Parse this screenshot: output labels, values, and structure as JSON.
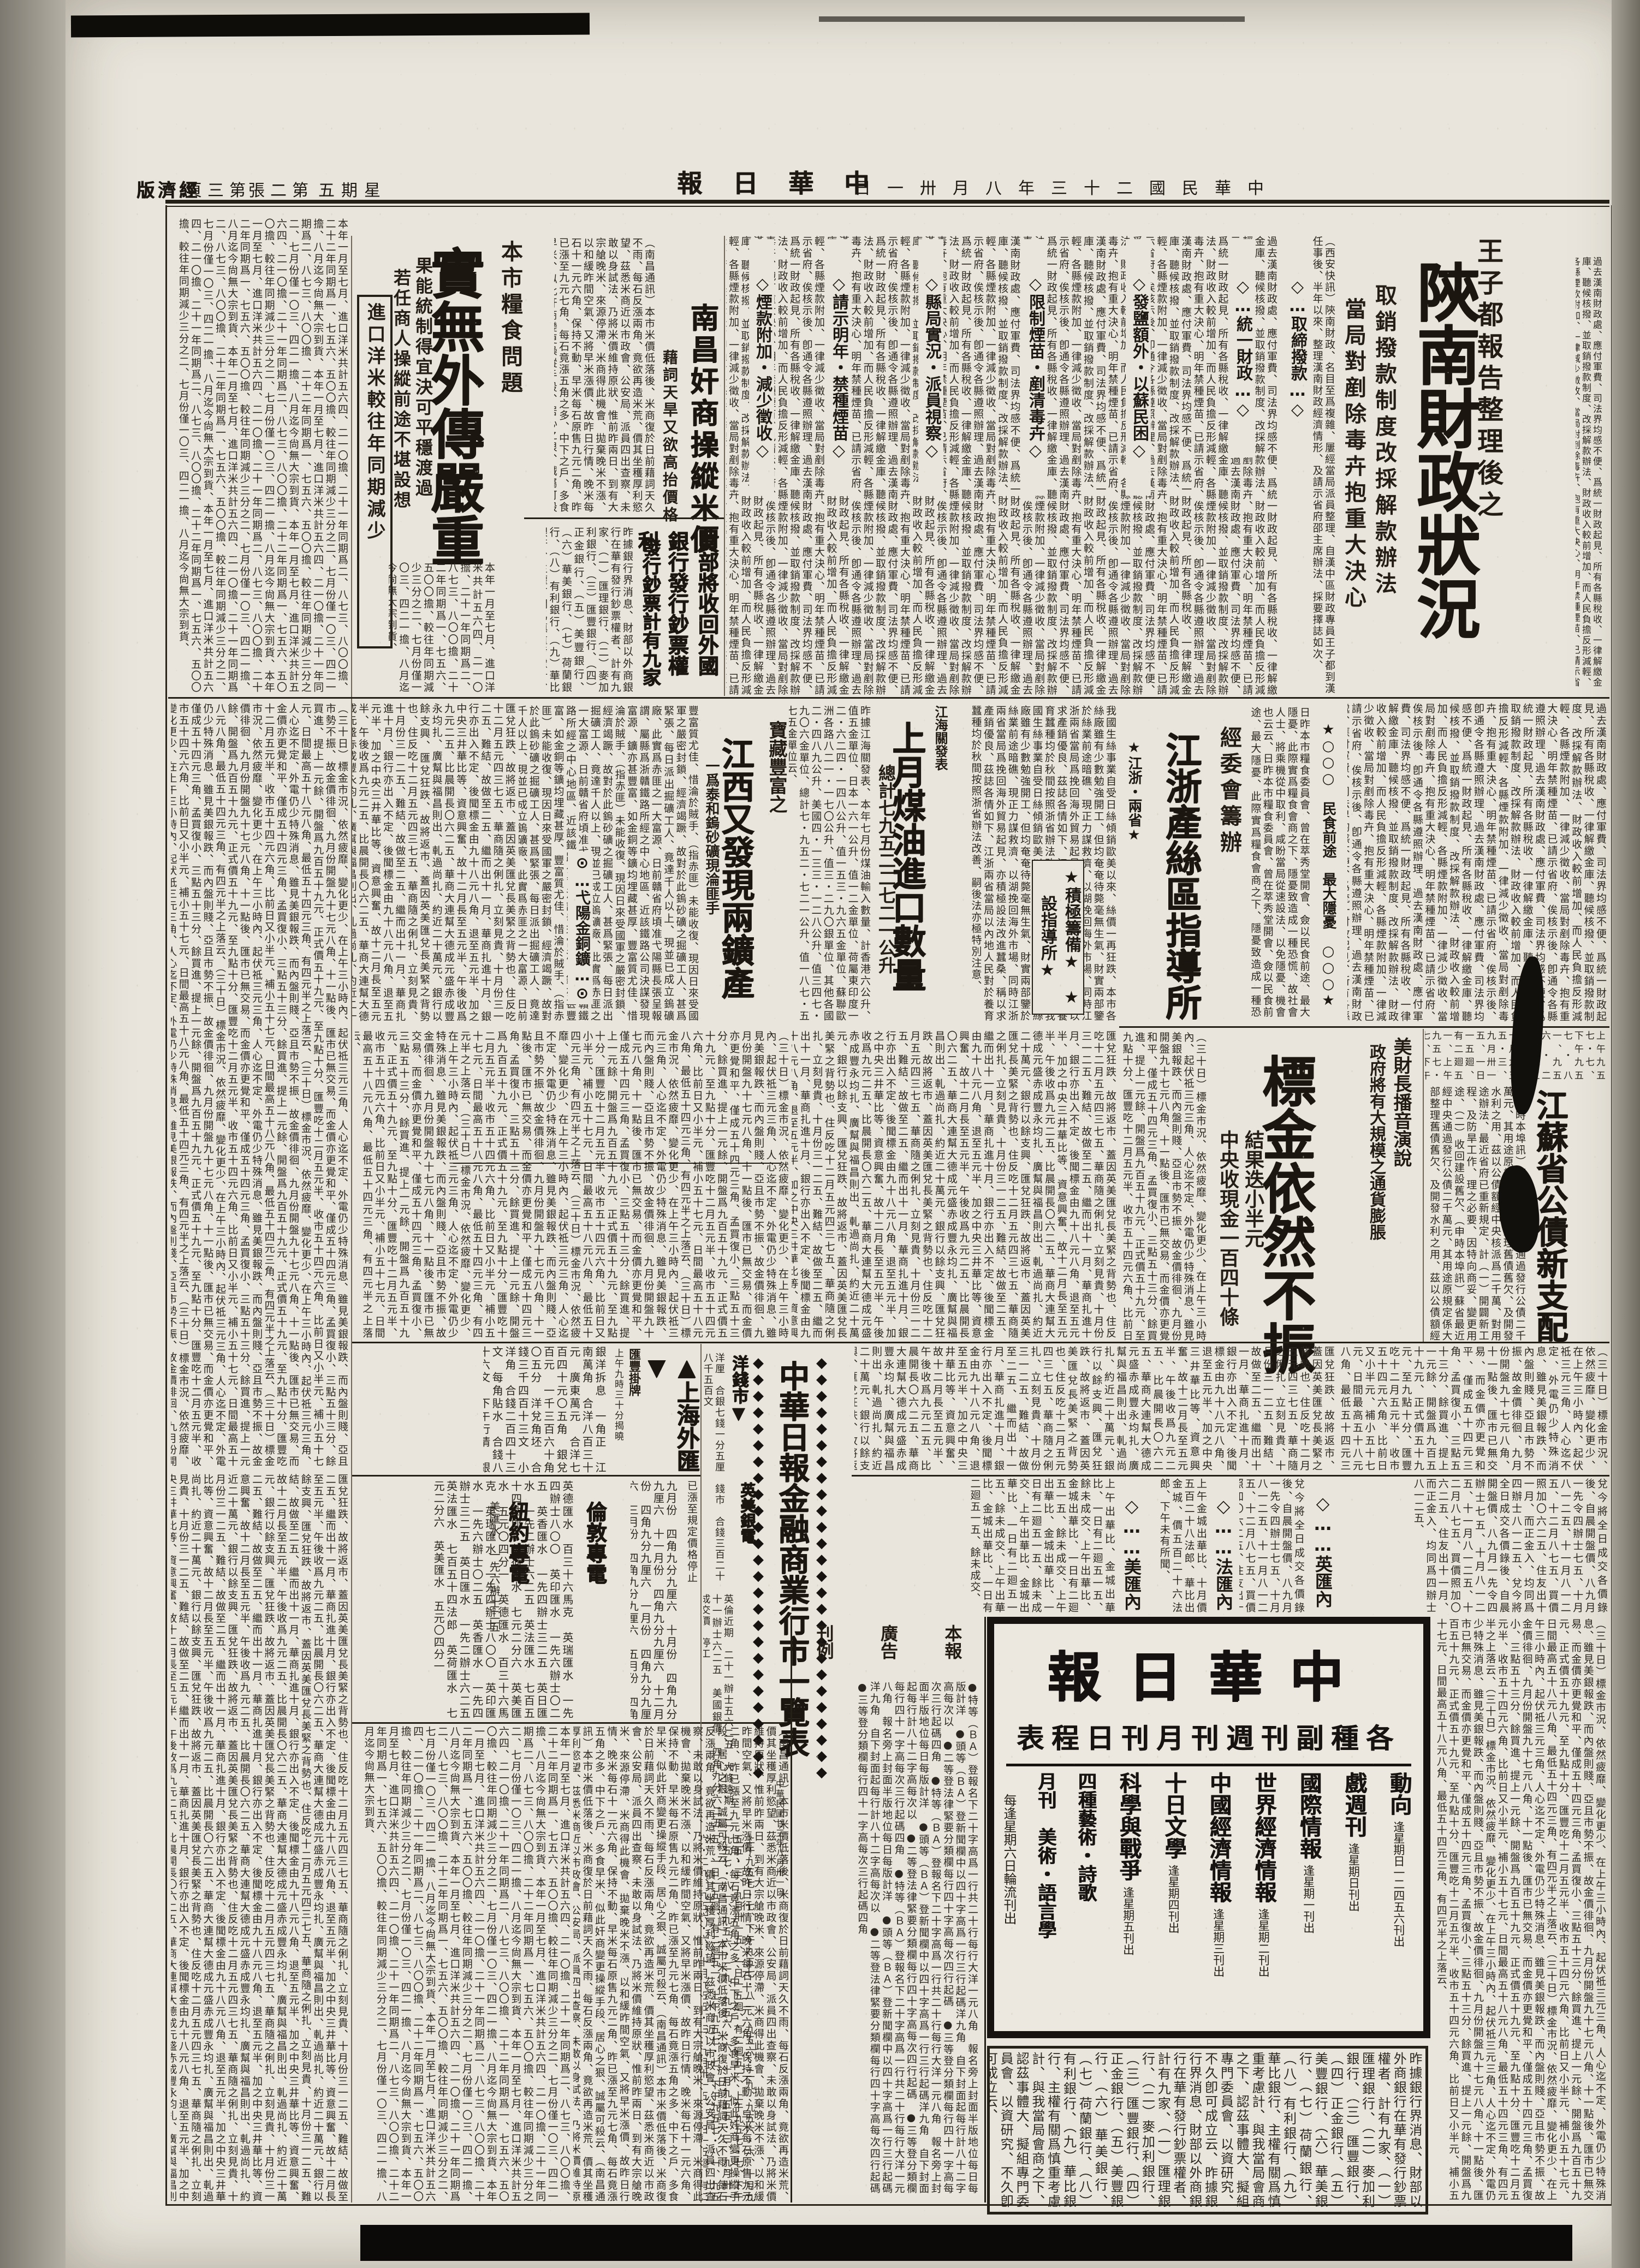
{
  "page": {
    "paper_color": "#e9e5dc",
    "ink_color": "#241f17"
  },
  "header": {
    "masthead": "中華日報",
    "date": "中華民國二十三年八月卅一日",
    "weekday": "星期五",
    "sheet": "第二張",
    "page_no": "第三頁",
    "section": "經濟版"
  },
  "stories": {
    "shaanxi": {
      "kicker": "王子都報告整理後之",
      "headline": "陝南財政狀況",
      "deck1": "取銷撥款制度改採解款辦法",
      "deck2": "當局對剷除毒卉抱重大決心",
      "lead": "（西安快訊）陝南財政、名目至爲複雜、屢經當局派員整理、自漢中區財政專員王子都到漢任事後、半年以來、整理漢南財政經濟情形、及請示省府邵主席辦法、採要擇誌如次、",
      "subheads": [
        "◇…取締撥款…◇",
        "◇…統一財政…◇",
        "◇發鹽額外・以蘇民困◇",
        "◇限制煙苗・剷清毒卉◇",
        "◇縣局實況・派員視察◇",
        "◇請示明年・禁種煙苗◇",
        "◇煙款附加・減少徵收◇"
      ]
    },
    "food": {
      "kicker": "本市糧食問題",
      "headline": "實無外傳嚴重",
      "deck1": "果能統制得宜決可平穩渡過",
      "deck2": "若任商人操縱前途不堪設想",
      "box_label": "進口洋米較往年同期減少"
    },
    "nanchang": {
      "headline": "南昌奸商操縱米價",
      "deck": "藉詞天旱又欲高抬價格"
    },
    "banknotes": {
      "headline": "財部將收回外國銀行發行鈔票權利",
      "deck": "發行鈔票計有九家"
    },
    "minfood": {
      "head": "★○○○　民食前途　最大隱憂　○○○★"
    },
    "silk": {
      "kicker": "經委會籌辦",
      "headline": "江浙產絲區指導所",
      "star1": "★江浙・兩省★",
      "starbox": "★積極籌備★　★設指導所★"
    },
    "kerosene": {
      "kicker": "江海關發表",
      "headline": "上月煤油進口數量",
      "deck": "總計七九五二二七二一公升"
    },
    "mines": {
      "kicker": "寶藏豐富之",
      "headline": "江西又發現兩鑛產",
      "deck": "一爲泰和鎢砂礦現淪匪手",
      "subhead": "⊙…弋陽金銅鑛…⊙"
    },
    "bonds": {
      "headline": "江蘇省公債新支配"
    },
    "gold": {
      "kicker1": "美財長播音演說",
      "kicker2": "政府將有大規模之通貨膨脹",
      "headline": "標金依然不振",
      "deck1": "結果迭小半元",
      "deck2": "中央收現金一百四十條"
    }
  },
  "tables": {
    "banner": "中華日報金融商業行市一覽表",
    "banner_note": "中華民國廿三年八月卅一日",
    "banner_deco": "◆",
    "shfx_header": "▲上海外匯▼",
    "shfx_sub": "匯豐掛牌",
    "shfx_time": "上午九時三十分揭曉",
    "shfx_rows": "銀洋拆息　一角正　江南萬角　合洋八百三十元　廣東萬元　合洋七百四十元〇五角　銀兌百元　一千三百六十角〇五分　洋兌角坯　合錢三千四百十三文　小洋角　合錢二百四十三文　每角貼水　合錢八十六文　下午行情　銀洋拆息　一角正　江南萬角　合洋八百三十元　廣東萬元　合洋七百四十元〇五角　銀兌百元　一千三百六十角〇五分　每角貼水　合錢八十六文",
    "ny_header": "紐約專電",
    "ny_rows": "美匯水　一先六辦士二五",
    "ldn_header": "倫敦專電",
    "ldn_rows": "英德匯水　百三十六馬克　英瑞匯水　一先四辦士八〇〇　英印匯水　一先六辦士〇二五　英香匯水　一先四辦士三二五　英日匯水　一先二辦士六二五　英法匯水　七百五十四法郎　英荷匯水　七元二分六　英美匯水　五元〇四分一　",
    "silver_note": "已漲至規定價格停止",
    "silver_rows": "九月份　四角九分九厘六　十月份　四角九分九厘六　十一月份　四角九分九厘六　十二月份　四角九分九厘六　一月份　四角九分九厘六　三月份　四角九分九厘六　五月份　四角九分九厘六　",
    "ym_header": "英美銀電",
    "ym_rows": "英倫近期　二十一辦士五六二五　大條遠期　二十一辦士六二五　美國銀價　四角九分六二五　成交價　停工",
    "yq_header": "洋錢市▼",
    "yq_rows": "洋厘　合銀七錢一分五厘　錢市　合錢三百二十八千五百文",
    "np_ying": "◇……英匯內盤……◇",
    "np_fa": "◇……法匯內盤……◇",
    "np_mei": "◇……美匯內盤……◇"
  },
  "adbox": {
    "brand": "中華日報",
    "title": "各種副刊週刊月刊日程表",
    "items": [
      {
        "name": "動向",
        "sched": "逢星期日一二四五六刊出"
      },
      {
        "name": "戲週刊",
        "sched": "逢星期日刊出"
      },
      {
        "name": "國際情報",
        "sched": "逢星期一刊出"
      },
      {
        "name": "世界經濟情報",
        "sched": "逢星期二刊出"
      },
      {
        "name": "中國經濟情報",
        "sched": "逢星期三刊出"
      },
      {
        "name": "十日文學",
        "sched": "逢星期四刊出"
      },
      {
        "name": "科學與戰爭",
        "sched": "逢星期五刊出"
      },
      {
        "name": "四種藝術・詩歌",
        "sched": ""
      },
      {
        "name": "月刊　美術・語言學",
        "sched": ""
      }
    ],
    "note": "每逢星期六日輪流刊出"
  },
  "rates": {
    "labels": [
      "本報",
      "廣告",
      "刊例"
    ],
    "body": "●特等（ＢＡ）登報名下二十字高爲一行共二十行每行大洋一元八角　報名旁上封面半版地位每日每版計洋　●頭等（ＢＡ）登新聞欄中以四十字高爲一行三行起碼洋九角　自下封面起每行計八十二字高每次以　●二等登法律緊要分類欄每行四十字高每次四行起碼　●三等登分類欄每行四十一字高每次三行起碼四角　"
  },
  "filler": {
    "f1": "過去漢南財政處、應付軍費、司法界均感不便、爲統一財政起見、所有各縣稅收、一律解繳金庫、聽候核撥、並取銷撥款制度、改採解款辦法、財政收入較前增加、而人民負擔反形減輕、各縣煙款附加、一律減少徵收、當局對剷除毒卉、抱有重大決心、明年禁種煙苗、已請示省府、俟核示後、卽通令各縣遵照辦理、",
    "f2": "（南昌通訊）本市米價低落後、米商復於日前藉詞天久不雨、每石反漲兩角、竟欲再造米荒、價其坐穫厚利慾望、茲悉米商近以市政會、公安局、派員四出查察、未敢以身試法、乃將米價維持原狀、惟前昨兩日、到有大宗艙晚米、來源停滯、米商得此機會、拋棄晚米不漲、以和緩昨間空氣、又將早米漲價、故昨日行情、晚米每石十一元六角、保持不動、早米每石原售九元二角、昨已漲至九元七角、每石竟漲五角之多、中下之戶、多食早米、似此奸商變更操縱手段、居心之狠、誠屬可殺云、",
    "f3": "昨據銀行界消息、財部以外商銀行在華有發行鈔票權者、計有九家、（一）匯理銀行、（二）麥加利銀行、（三）匯豐銀行、（四）正金銀行、（五）美豐銀行、（六）華美銀行、（七）荷蘭銀行、（八）有利銀行、（九）華比銀行、主權有關爲慎重考慮計、與我當局會商之下、認茲事體大、擬組專門委員會、以資研究、不久卽可成立云、",
    "f4": "我國生絲事業自受日絲傾銷歐美以來、絲價一再狂跌、本市各絲廠雖有少數勉強開工、但均奄奄待斃毫無生氣、財實兩部鑒於絲業前途暗礁、現正力謀救濟、以湖挽回海外市場、同時江浙兩省當局爲挽回海外貿易起見、亦積極設法改進蠶桑、稱以求產銷優良、茲誌各情如下、江浙兩省當局以內地人民對於養育蠶種均於秋間按照浙省辦法改善、嗣後法亦極特別注意、",
    "f5": "昨據江海關發表、本年七月份煤油輸入數量、計香港六公升、值五金單位、日本一六一公升、值一二金單位、荷屬東印度一二・六二四・一四八公升、值一五三・九六五金單位、蘇聯歐洲各路八二一・一七〇公升、值三・二九〇銀單位、其他各國二・四八九公升、美國四・一三三・一二八公升、值三四七・九〇六金單位、總計七・九五二・七二一公升、值一八七・五七五金單位云、",
    "f6": "（三十日）標金市況、依然疲靡、變化更少、在上午三小時內、起伏祗三元三角、人心迄不定、外電仍少特殊消息、雖見美銀報跌、而內盤則賤、亞且市勢不振、故金價徘徊、九月份開盤九十七元八角、十一點後、匯市已無交易、而金價亦更覺和平、僅成五十四元三角、孟買復小、三點五十三分、餘買進、提上一元餘、開盤爲九百五十九元、正式價五十九元、至九點十分、匯豐吃十二月五元半、收市五十四元六角、比前日又小半元、補小五十七元、日間最高五十八元八角、最低五十四元三角、有四元半之上落云、",
    "f7": "匯兌狂跌、故將返市、蓋因英美匯兌長美緊之背勢也、住反吃十二月五元四三七五、華商隨之俐扎、立刻見貴、十月份三一二五、難結、故做至二五、繼而出十一月、華商扎進十月、銀行亦出入不定、後聞標金由九十八元八角、退至五元半、加之中央三井華比等、資意興奮、故十二月長至五元半、午後收爲九元二五、比晨開長〇六二五、華商大連幫大德成元盛赤成豐永均扎、廣幫與福昌則出、軋過尚扎、約近二十萬元、銀行以餘支興、",
    "f8": "（申時本埠訊）蘇省最近經中央通過發行公債二千萬元、其用途原規定係大部整理舊債舊欠、及開發水利之用、茲以公債額經中央核派爲二千萬、對用途辦法、最近省府已重新規定、計（一）開闢新工程、及防旱工作、理之必要、因特向商妥、變更用途、（二）收回建設舊欠、",
    "f9": "豐富質尤佳、惜淪於賊手、（指赤匪）未能收復、現因日來受國軍之嚴密封鎖、經濟竭蹶、故對於此鎢砂礦之掘礦工人、甚爲緊張、每日派出掘礦工人、竟達千人以上、現並已成立鎢礦廠、此實爲赤匪之一大富源、日前贛省府頃准弋陽縣長張呈報謂、屬縣爲浙贛鐵路所經之中心地區、近該鐵路公司決謀發現富源、鑛亦甚豐富、如金銅等鑛均埋藏甚厚、",
    "f10": "日昨本市糧食委員會、曾在萃秀堂開會、僉以民食前途、最大隱憂、此際實爲糧食會商之下、隱憂致造成一種恐慌、故社會人士、將乘機從中取利、咸盼當局從速設法、以免隱憂、機會也云云、",
    "f11": "本年一月至七月、進口洋米共計五六四、二一〇擔、二十一年同期爲二、八七三、八〇〇擔、二十二年同期爲一、七五六、五〇〇擔、較往年同期減少三分之二、七月份僅一〇三、四二一擔、八月迄今尙無大宗到貨、",
    "f12": "上午九五七・七、下午九五七・八一、九五六・二九、九五六・六、十月九五五・三、九月卅一五、一日一五廻、有二廻五一、",
    "f_ying": "兌今將全日成交各價錄後、自晨開盤價、八九月一先令四辦士七五、十月八一二五、十一月八一二五、十二月八七五、買價照加〇六二五、住友出十一月、而正金入、均同爲四辦士八一二五、",
    "f_fa": "上午金城出華比、十月價五百二十八法郎、華比出金城、價五百二十六法郎、下午未有所聞、",
    "f_mei": "上午出華比、金城出華比、一日有二廻五一五、餘未成交、"
  }
}
